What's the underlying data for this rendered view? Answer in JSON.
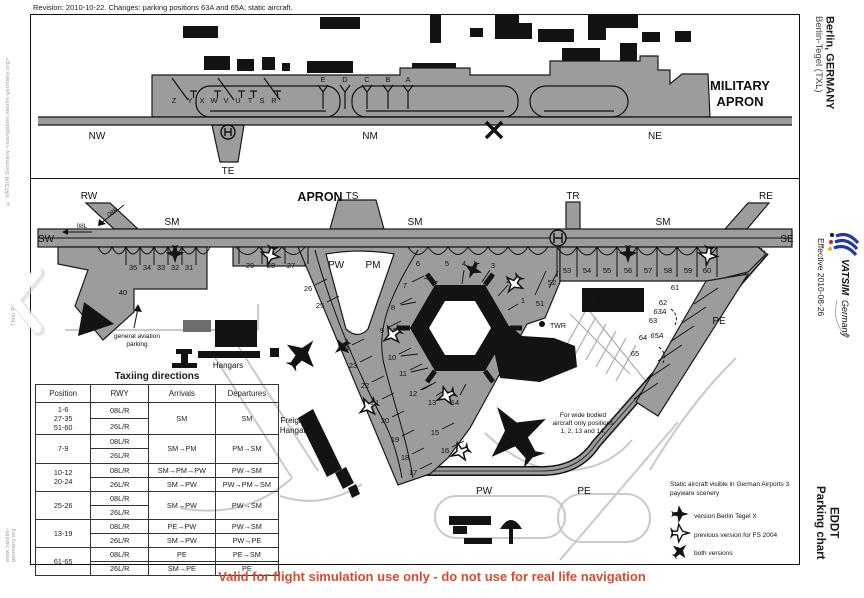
{
  "page": {
    "revision_note": "Revision: 2010-10-22. Changes: parking positions 63A and 65A; static aircraft.",
    "footer_warning": "Valid for flight simulation use only - do not use for real life navigation",
    "copyright_vertical": "© VATSIM Germany <navigation.vatsim-germany.org>",
    "author_vertical": "Thilo Partis",
    "website_vertical": "www.vatsim-germany.org"
  },
  "margin": {
    "region": "Berlin, GERMANY",
    "airport": "Berlin-Tegel (TXL)",
    "effective": "Effective 2010-08-26",
    "chart_code": "EDDT",
    "chart_type": "Parking chart",
    "logo_brand": "VATSIM",
    "logo_suffix": "Germany"
  },
  "military": {
    "title_line1": "MILITARY",
    "title_line2": "APRON",
    "tw_nw": "NW",
    "tw_nm": "NM",
    "tw_ne": "NE",
    "tw_te": "TE",
    "stands": {
      "z": "Z",
      "y": "Y",
      "x": "X",
      "w": "W",
      "v": "V",
      "u": "U",
      "t": "T",
      "s": "S",
      "r": "R",
      "e": "E",
      "d": "D",
      "c": "C",
      "b": "B",
      "a": "A"
    }
  },
  "apron": {
    "title": "APRON",
    "tw": {
      "rw": "RW",
      "ts": "TS",
      "tr": "TR",
      "re": "RE",
      "sw": "SW",
      "se": "SE",
      "sm1": "SM",
      "sm2": "SM",
      "sm3": "SM",
      "pw": "PW",
      "pm": "PM",
      "pw2": "PW",
      "pe1": "PE",
      "pe2": "PE",
      "twr": "TWR",
      "r08r": "08R",
      "r08l": "08L"
    },
    "stands": {
      "s35": "35",
      "s34": "34",
      "s33": "33",
      "s32": "32",
      "s31": "31",
      "s40": "40",
      "s29": "29",
      "s28": "28",
      "s27": "27",
      "s26": "26",
      "s25": "25",
      "s24": "24",
      "s23": "23",
      "s22": "22",
      "s21": "21",
      "s20": "20",
      "s19": "19",
      "s18": "18",
      "s17": "17",
      "s6": "6",
      "s5": "5",
      "s4": "4",
      "s3": "3",
      "s2": "2",
      "s1": "1",
      "s7": "7",
      "s8": "8",
      "s9": "9",
      "s10": "10",
      "s11": "11",
      "s12": "12",
      "s13": "13",
      "s14": "14",
      "s15": "15",
      "s16": "16",
      "s51": "51",
      "s52": "52",
      "s53": "53",
      "s54": "54",
      "s55": "55",
      "s56": "56",
      "s57": "57",
      "s58": "58",
      "s59": "59",
      "s60": "60",
      "s61": "61",
      "s62": "62",
      "s63": "63",
      "s63a": "63A",
      "s64": "64",
      "s65": "65",
      "s65a": "65A"
    },
    "notes": {
      "ga1": "general aviation",
      "ga2": "parking",
      "hangars": "Hangars",
      "freight1": "Freight",
      "freight2": "Hangar",
      "terminal_c": "Terminal C",
      "wb1": "For wide bodied",
      "wb2": "aircraft only positions",
      "wb3": "1, 2, 13 and 14."
    }
  },
  "legend": {
    "intro1": "Static aircraft visible in German Airports 3",
    "intro2": "payware scenery",
    "item1": "version Berlin Tegel X",
    "item2": "previous version for FS 2004",
    "item3": "both versions"
  },
  "table": {
    "title": "Taxiing directions",
    "headers": [
      "Position",
      "RWY",
      "Arrivals",
      "Departures"
    ],
    "groups": [
      {
        "pos": [
          "1-6",
          "27-35",
          "51-60"
        ],
        "rwy": [
          "08L/R",
          "26L/R"
        ],
        "arr": [
          "SM"
        ],
        "dep": [
          "SM"
        ]
      },
      {
        "pos": [
          "7-9"
        ],
        "rwy": [
          "08L/R",
          "26L/R"
        ],
        "arr": [
          "SM→PM"
        ],
        "dep": [
          "PM→SM"
        ]
      },
      {
        "pos": [
          "10-12",
          "20-24"
        ],
        "rwy": [
          "08L/R",
          "26L/R"
        ],
        "arr": [
          "SM→PM→PW",
          "SM→PW"
        ],
        "dep": [
          "PW→SM",
          "PW→PM→SM"
        ]
      },
      {
        "pos": [
          "25-26"
        ],
        "rwy": [
          "08L/R",
          "26L/R"
        ],
        "arr": [
          "SM→PW"
        ],
        "dep": [
          "PW→SM"
        ]
      },
      {
        "pos": [
          "13-19"
        ],
        "rwy": [
          "08L/R",
          "26L/R"
        ],
        "arr": [
          "PE→PW",
          "SM→PW"
        ],
        "dep": [
          "PW→SM",
          "PW→PE"
        ]
      },
      {
        "pos": [
          "61-65"
        ],
        "rwy": [
          "08L/R",
          "26L/R"
        ],
        "arr": [
          "PE",
          "SM→PE"
        ],
        "dep": [
          "PE→SM",
          "PE"
        ]
      }
    ]
  }
}
